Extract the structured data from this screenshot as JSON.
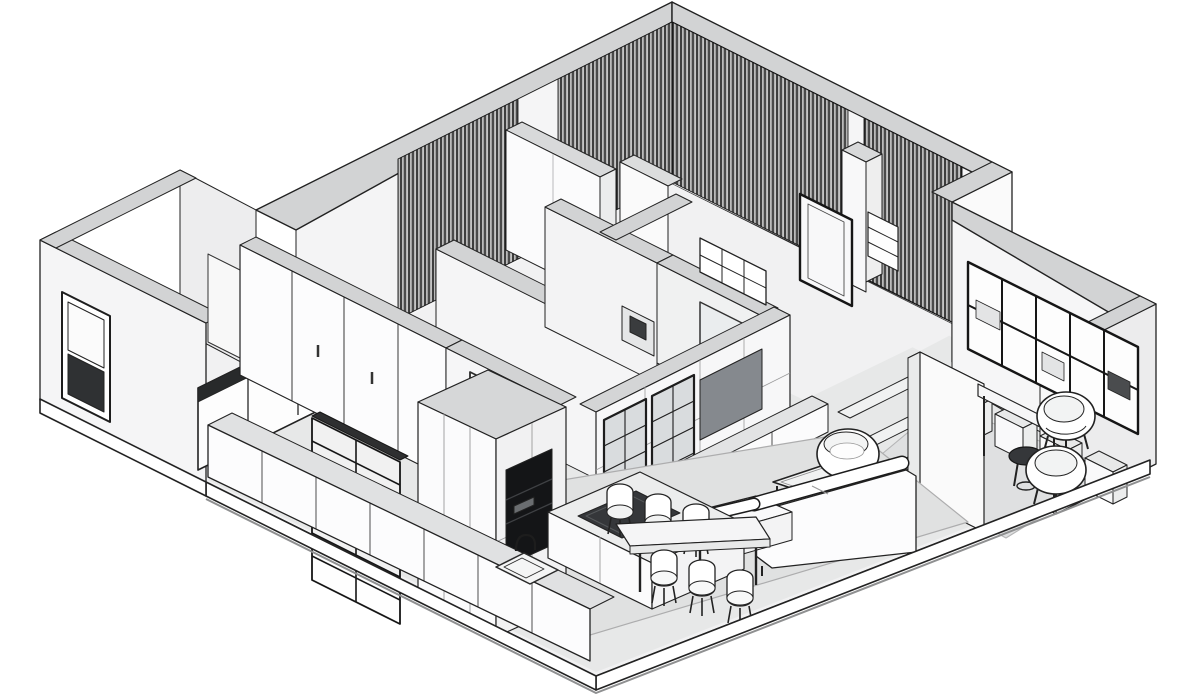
{
  "canvas": {
    "width": 1200,
    "height": 696,
    "background": "#ffffff"
  },
  "scene": {
    "type": "isometric-floor-plan",
    "style": "monochrome architectural cutaway axonometric",
    "palette": {
      "outline": "#1f1f1f",
      "wall_top": "#d2d3d4",
      "wall_face": "#f5f5f6",
      "wall_face_shaded": "#ececed",
      "floor_open": "#e7e8e8",
      "floor_room": "#f1f1f2",
      "rug": "#e0e1e1",
      "tv_screen": "#85898e",
      "cooktop": "#35373a",
      "curtain_dark": "#1b1b1b",
      "curtain_light": "#cbcbcb",
      "slab_edge": "#ffffff"
    },
    "labels": {
      "floor_plan": "Isometric apartment cutaway floor plan",
      "floor_slab": "Floor slab with cut edges",
      "exterior_walls": "Exterior walls with gray wall tops",
      "entry": "Entry block with exterior window",
      "glazed_partition": "Glazed interior partition of entry room",
      "bedrooms": "Bedroom wing with floor-to-ceiling curtains",
      "curtains": "Dark pleated curtains on window walls",
      "closets": "Bedroom closet volumes",
      "corridor": "Corridor wall",
      "bathrooms": "Bathroom partitions with shower enclosure",
      "master_door": "Dark framed bedroom door panel with cubby shelf",
      "study": "Study with bookshelves, desk and armchairs",
      "bookshelf": "Black-frame wall bookshelf",
      "cube_storage": "Row of storage cubes",
      "column_shelf": "Open shelving column with five boards",
      "desk": "Wall-mounted desk",
      "armchairs": "Pair of tub armchairs with round side table",
      "living_room": "Living room",
      "tv_wall": "Media wall with display cabinets",
      "tv": "Television panel",
      "console": "Low media console",
      "rug_living": "Living room area rug",
      "rug_study": "Study area rug",
      "coffee_table": "Coffee table",
      "barrel_chair": "Barrel swivel chair",
      "sofa": "Sectional sofa with chaise",
      "wardrobe": "Sliding-door wardrobe wall",
      "hall_door": "Hallway double door",
      "kitchen": "Kitchen",
      "rack": "Black metal open shelving rack",
      "tall_cabinets": "Tall cabinet block with dark oven niche",
      "counter": "Kitchen counter with sink and faucet",
      "island": "Kitchen island with cooktop",
      "dining": "Dining table with six chairs"
    }
  }
}
